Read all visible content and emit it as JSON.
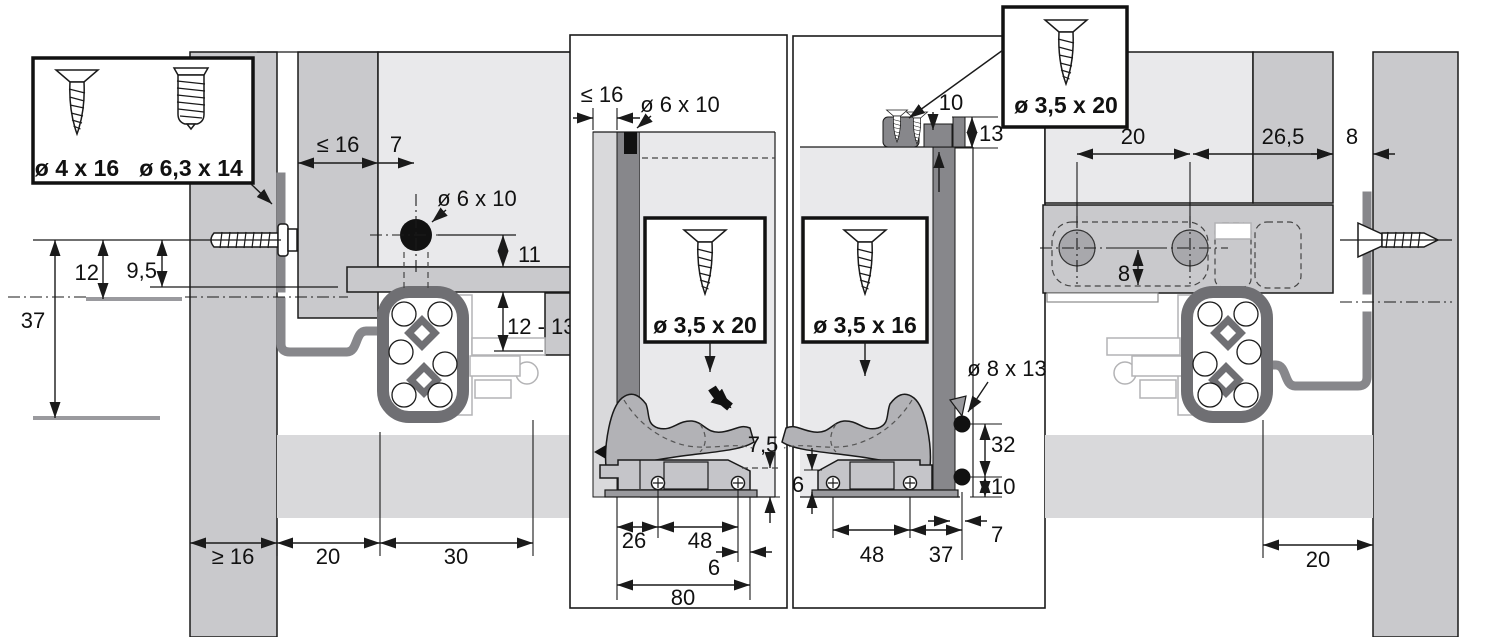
{
  "legend": {
    "label_screw_a": "ø 4 x 16",
    "label_screw_b": "ø 6,3 x 14"
  },
  "side_view": {
    "dim_12": "12",
    "dim_9_5": "9,5",
    "dim_37": "37",
    "dim_back_le16": "≤ 16",
    "dim_7": "7",
    "hole_label": "ø 6 x 10",
    "dim_11": "11",
    "dim_12_13": "12 - 13",
    "dim_ge16": "≥ 16",
    "dim_20": "20",
    "dim_30": "30"
  },
  "front_section": {
    "dim_le16": "≤ 16",
    "hole_label": "ø 6 x 10",
    "screw_label": "ø 3,5 x 20",
    "dim_7_5": "7,5",
    "dim_26": "26",
    "dim_48": "48",
    "dim_6": "6",
    "dim_80": "80"
  },
  "rear_section": {
    "dim_10": "10",
    "dim_13": "13",
    "screw_top_label": "ø 3,5 x 20",
    "screw_label": "ø 3,5 x 16",
    "hole_label": "ø 8 x 13",
    "dim_32": "32",
    "dim_10b": "10",
    "dim_6": "6",
    "dim_48": "48",
    "dim_37": "37",
    "dim_7": "7"
  },
  "rear_view": {
    "dim_20": "20",
    "dim_26_5": "26,5",
    "dim_8": "8",
    "dim_8_inner": "8",
    "dim_20_bottom": "20"
  },
  "colors": {
    "outline": "#1a1a1a",
    "panel_gray": "#c9c9cc",
    "light_gray": "#e9e9eb",
    "band_gray": "#d9d9db",
    "dark_gray": "#87878b",
    "rail_gray": "#6f6f73",
    "latch_gray": "#b2b2b6",
    "cam_gray": "#a8a8ac"
  }
}
